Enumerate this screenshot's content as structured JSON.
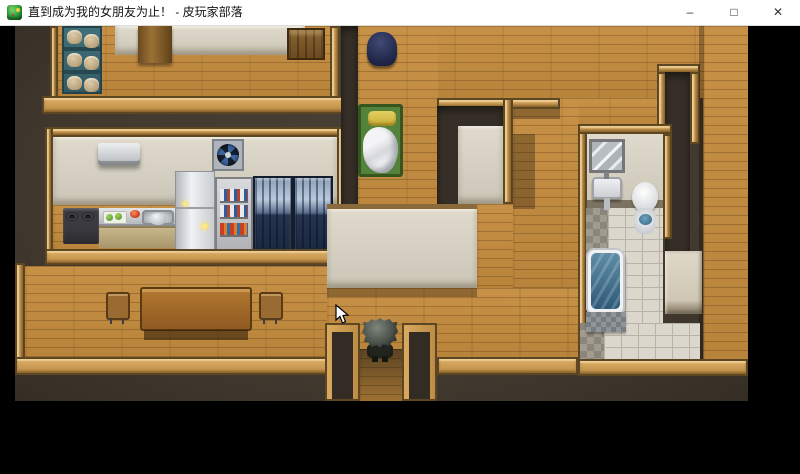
{
  "window": {
    "title": "直到成为我的女朋友为止！ - 皮玩家部落",
    "icon": "rpg-maker-game-icon",
    "controls": {
      "minimize": "–",
      "maximize": "□",
      "close": "✕"
    }
  },
  "game": {
    "scene": "top-down-house-interior-map",
    "sparkle_glyph": "✦",
    "rooms": [
      "storage-room",
      "kitchen",
      "dining-room",
      "bedroom",
      "hallway",
      "bathroom",
      "right-corridor"
    ],
    "objects": [
      "bread-shelf",
      "wooden-cabinet",
      "wooden-pillar",
      "air-conditioner",
      "ventilation-fan",
      "stove",
      "kitchen-counter",
      "cutting-board",
      "kitchen-sink",
      "refrigerator",
      "dish-shelf",
      "display-cabinet-left",
      "display-cabinet-right",
      "dining-table",
      "chair-left",
      "chair-right",
      "armor-stand",
      "bed",
      "mirror",
      "bathroom-sink",
      "toilet",
      "bathtub",
      "bath-mat",
      "changing-mat",
      "player-character",
      "mouse-cursor",
      "south-doorway"
    ],
    "colors": {
      "floor_wood": "#c18d43",
      "wall_dark": "#463d32",
      "trim_wood": "#c9995a",
      "wall_face_beige": "#d6d1c3",
      "tile_white": "#dbd7cd",
      "tile_gray": "#9b968c",
      "water_blue": "#4d7f9b",
      "display_cabinet_blue": "#2c3a52",
      "bed_green": "#55823a",
      "pillow_yellow": "#d9c153",
      "sparkle_yellow": "#ffe97a"
    }
  }
}
